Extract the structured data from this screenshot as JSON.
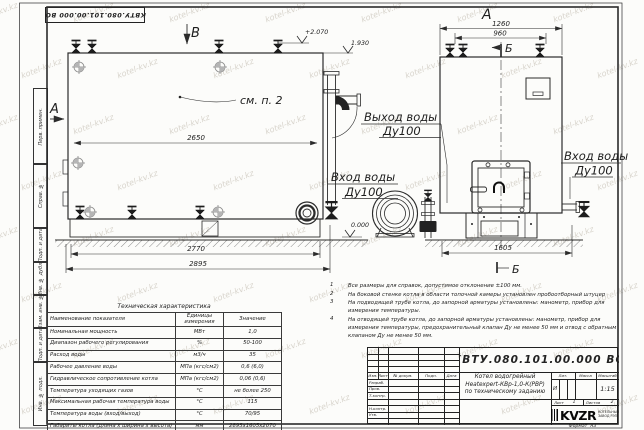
{
  "watermark": {
    "text": "kotel-kv.kz"
  },
  "doc_number": "КВТУ.080.101.00.000  ВО",
  "side_strip": {
    "items": [
      "Перв. примен.",
      "Справ. №",
      "Подп. и дата",
      "Инв. № дубл.",
      "Взам. инв. №",
      "Подп. и дата",
      "Инв. № подл."
    ]
  },
  "drawing": {
    "view_b_label": "В",
    "view_a_arrow_label": "А",
    "view_a_title": "А",
    "section_b_top": "Б",
    "section_b_bottom": "Б",
    "see_note": "см. п. 2",
    "elevations": {
      "top": "+2.070",
      "mid": "1.930",
      "zero": "0.000"
    },
    "dims": {
      "d2650": "2650",
      "d2770": "2770",
      "d2895": "2895",
      "d1260": "1260",
      "d960": "960",
      "d1605": "1605"
    },
    "outlet": {
      "line1": "Выход воды",
      "line2": "Ду100"
    },
    "inlet_left": {
      "line1": "Вход воды",
      "line2": "Ду100"
    },
    "inlet_right": {
      "line1": "Вход воды",
      "line2": "Ду100"
    }
  },
  "notes": [
    {
      "num": "1",
      "text": "Все размеры для справок, допустимое отклонение  ±100 мм."
    },
    {
      "num": "2",
      "text": "На боковой стенке котла в области топочной камеры установлен пробоотборный штуцер"
    },
    {
      "num": "3",
      "text": "На  подводящей трубе котла, до запорной арматуры установлены:  манометр, прибор для измерения температуры."
    },
    {
      "num": "4",
      "text": "На отводящей трубе котла, до запорной арматуры установлены:  манометр, прибор для измерения температуры, предохранительный клапан  Ду не менее  50 мм и отвод с обратным клапаном  Ду не менее  50 мм."
    }
  ],
  "tech_table": {
    "title": "Техническая характеристика",
    "headers": {
      "name": "Наименование показателя",
      "units": "Единицы измерения",
      "value": "Значение"
    },
    "rows": [
      {
        "name": "Номинальная мощность",
        "units": "МВт",
        "value": "1,0"
      },
      {
        "name": "Диапазон рабочего регулирования",
        "units": "%",
        "value": "50-100"
      },
      {
        "name": "Расход воды",
        "units": "м3/ч",
        "value": "35"
      },
      {
        "name": "Рабочее давление воды",
        "units": "МПа (кгс/см2)",
        "value": "0,6 (6,0)"
      },
      {
        "name": "Гидравлическое сопротивление котла",
        "units": "МПа (кгс/см2)",
        "value": "0,06 (0,6)"
      },
      {
        "name": "Температура уходящих газов",
        "units": "°С",
        "value": "не более 250"
      },
      {
        "name": "Максимальная рабочая температура воды",
        "units": "°С",
        "value": "115"
      },
      {
        "name": "Температура воды (вход/выход)",
        "units": "°С",
        "value": "70/95"
      },
      {
        "name": "Габариты котла (длина х ширина х высота)",
        "units": "мм",
        "value": "2895х1605х2070"
      }
    ]
  },
  "title_block": {
    "rev_headers": [
      "Изм.",
      "Лист",
      "№ докум.",
      "Подп.",
      "Дата"
    ],
    "sig_rows": [
      "Разраб.",
      "Пров.",
      "Т.контр.",
      "Н.контр.",
      "Утв."
    ],
    "name_lines": [
      "Котел водогрейный",
      "Heatexpert-КВр-1,0-К(РВР)",
      "по техническому заданию"
    ],
    "lit_label": "Лит.",
    "mass_label": "Масса",
    "scale_label": "Масштаб",
    "lit_value": "И",
    "scale_value": "1:15",
    "sheet_label": "Лист",
    "sheet_value": "1",
    "sheets_label": "Листов",
    "sheets_value": "2",
    "logo": "KVZR",
    "logo_sub1": "КОТЕЛЬНЫЙ",
    "logo_sub2": "ЗАВОД РЭП",
    "format_label": "Формат",
    "format_value": "А3"
  }
}
